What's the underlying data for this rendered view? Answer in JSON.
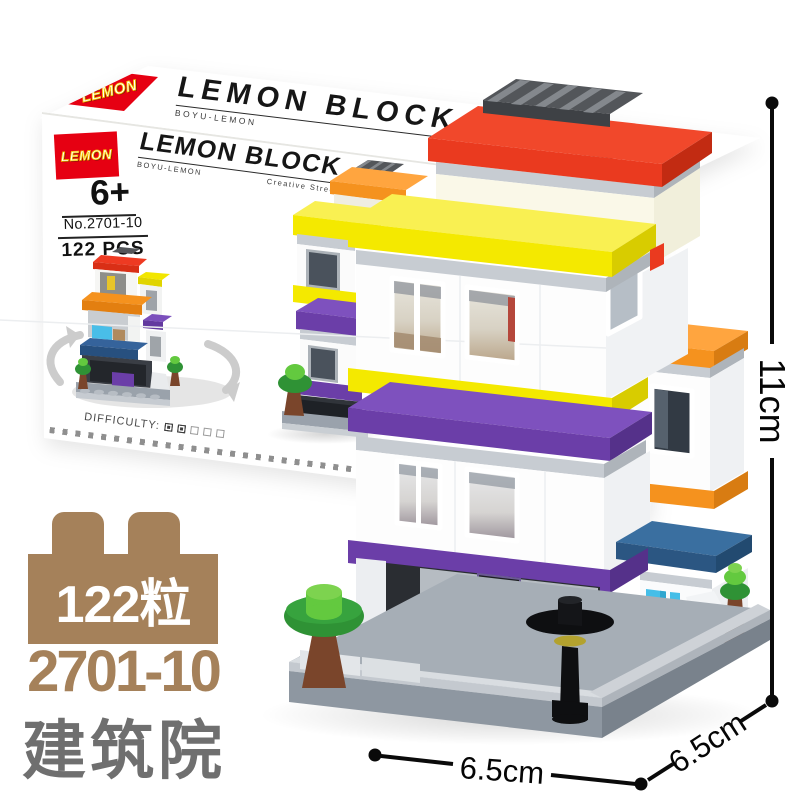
{
  "brand": {
    "logo_text": "LEMON",
    "title": "LEMON BLOCK",
    "subtitle_left": "BOYU-LEMON",
    "subtitle_right": "Creative Street Serie"
  },
  "box": {
    "age": "6+",
    "model_no": "No.2701-10",
    "pieces": "122 PCS",
    "difficulty_label": "DIFFICULTY:",
    "difficulty_filled": 2,
    "difficulty_total": 5
  },
  "badges": {
    "piece_count": "122粒",
    "model_number": "2701-10",
    "product_name": "建筑院"
  },
  "dimensions": {
    "height": "11cm",
    "width": "6.5cm",
    "depth": "6.5cm"
  },
  "colors": {
    "c_red": "#EA3A1F",
    "c_red_logo": "#E60012",
    "c_yellow": "#F4E900",
    "c_orange": "#F5921E",
    "c_purple": "#6B3EA8",
    "c_purple_light": "#7E51BE",
    "c_steel_blue": "#3A6FA0",
    "c_cyan": "#45BEE8",
    "c_green": "#2F9235",
    "c_green_light": "#63C93F",
    "c_trunk": "#7A452B",
    "c_gray_base": "#9AA2AC",
    "c_gray_light": "#C7CCD2",
    "c_sidewalk": "#D9DDE1",
    "c_cream": "#FAF8E8",
    "c_glass": "#323A44",
    "c_brown": "#A5815A",
    "c_name_gray": "#6F6F6F"
  }
}
